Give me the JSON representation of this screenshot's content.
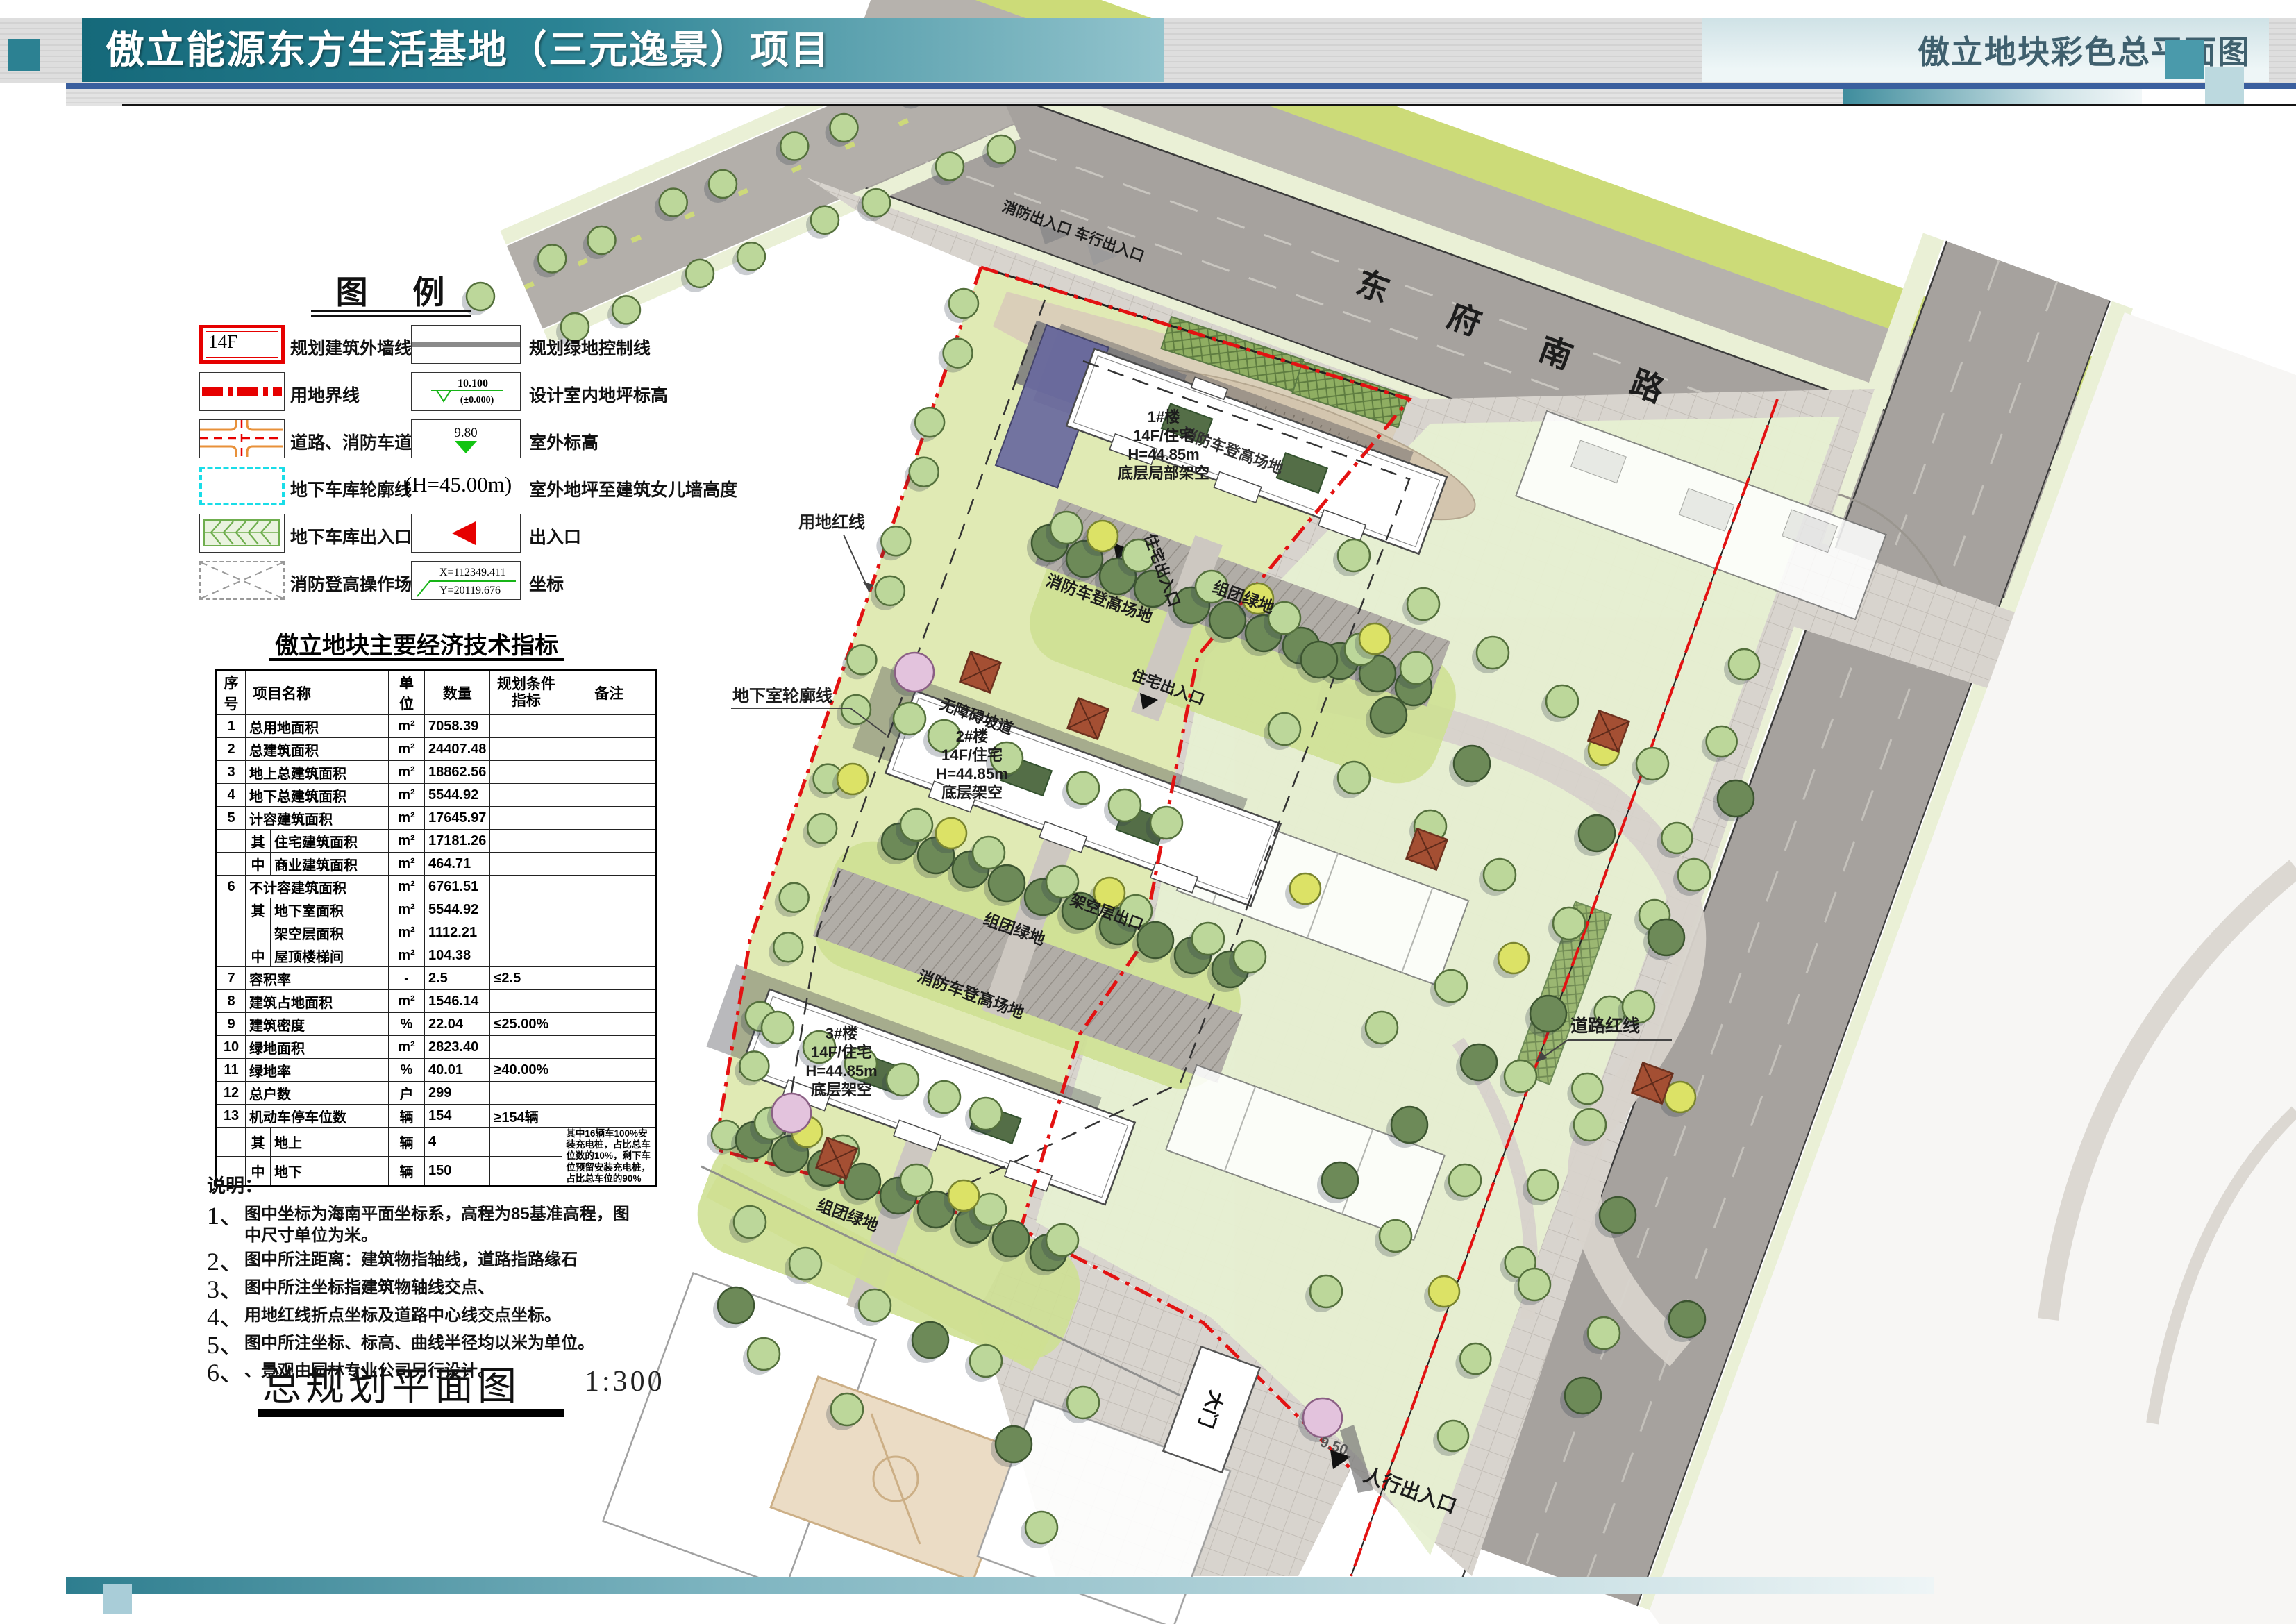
{
  "header": {
    "title": "傲立能源东方生活基地（三元逸景）项目",
    "subtitle": "傲立地块彩色总平面图"
  },
  "colors": {
    "header_teal": "#15697a",
    "header_blue_line": "#3a5f9e",
    "boundary_red": "#e31212",
    "garage_cyan": "#21dbe4",
    "road_gray": "#a6a29e",
    "site_green": "#e0eab4",
    "tree_green": "#bcd79a"
  },
  "legend": {
    "title": "图  例",
    "left": [
      {
        "symbol": "building-outline-symbol",
        "symbol_text": "14F",
        "label": "规划建筑外墙线及层数"
      },
      {
        "symbol": "land-boundary-symbol",
        "label": "用地界线"
      },
      {
        "symbol": "road-symbol",
        "label": "道路、消防车道"
      },
      {
        "symbol": "garage-outline-symbol",
        "label": "地下车库轮廓线"
      },
      {
        "symbol": "garage-entrance-symbol",
        "label": "地下车库出入口"
      },
      {
        "symbol": "fire-pad-symbol",
        "label": "消防登高操作场地"
      }
    ],
    "right": [
      {
        "symbol": "green-control-line-symbol",
        "label": "规划绿地控制线"
      },
      {
        "symbol": "indoor-level-symbol",
        "label": "设计室内地坪标高",
        "values": [
          "10.100",
          "(±0.000)"
        ]
      },
      {
        "symbol": "outdoor-level-symbol",
        "label": "室外标高",
        "value": "9.80"
      },
      {
        "symbol": "parapet-height-symbol",
        "label": "室外地坪至建筑女儿墙高度",
        "value": "(H=45.00m)"
      },
      {
        "symbol": "entrance-symbol",
        "label": "出入口"
      },
      {
        "symbol": "coordinate-symbol",
        "label": "坐标",
        "values": [
          "X=112349.411",
          "Y=20119.676"
        ]
      }
    ]
  },
  "indicators": {
    "title": "傲立地块主要经济技术指标",
    "headers": [
      "序号",
      "项目名称",
      "单位",
      "数量",
      "规划条件指标",
      "备注"
    ],
    "rows": [
      {
        "no": "1",
        "name": "总用地面积",
        "unit": "m²",
        "qty": "7058.39",
        "plan": "",
        "remark": ""
      },
      {
        "no": "2",
        "name": "总建筑面积",
        "unit": "m²",
        "qty": "24407.48",
        "plan": "",
        "remark": ""
      },
      {
        "no": "3",
        "name": "地上总建筑面积",
        "unit": "m²",
        "qty": "18862.56",
        "plan": "",
        "remark": ""
      },
      {
        "no": "4",
        "name": "地下总建筑面积",
        "unit": "m²",
        "qty": "5544.92",
        "plan": "",
        "remark": ""
      },
      {
        "no": "5",
        "name": "计容建筑面积",
        "unit": "m²",
        "qty": "17645.97",
        "plan": "",
        "remark": ""
      },
      {
        "no": "",
        "prefix": "其",
        "name": "住宅建筑面积",
        "unit": "m²",
        "qty": "17181.26",
        "plan": "",
        "remark": ""
      },
      {
        "no": "",
        "prefix": "中",
        "name": "商业建筑面积",
        "unit": "m²",
        "qty": "464.71",
        "plan": "",
        "remark": ""
      },
      {
        "no": "6",
        "name": "不计容建筑面积",
        "unit": "m²",
        "qty": "6761.51",
        "plan": "",
        "remark": ""
      },
      {
        "no": "",
        "prefix": "其",
        "name": "地下室面积",
        "unit": "m²",
        "qty": "5544.92",
        "plan": "",
        "remark": ""
      },
      {
        "no": "",
        "prefix": "",
        "name": "架空层面积",
        "unit": "m²",
        "qty": "1112.21",
        "plan": "",
        "remark": ""
      },
      {
        "no": "",
        "prefix": "中",
        "name": "屋顶楼梯间",
        "unit": "m²",
        "qty": "104.38",
        "plan": "",
        "remark": ""
      },
      {
        "no": "7",
        "name": "容积率",
        "unit": "-",
        "qty": "2.5",
        "plan": "≤2.5",
        "remark": ""
      },
      {
        "no": "8",
        "name": "建筑占地面积",
        "unit": "m²",
        "qty": "1546.14",
        "plan": "",
        "remark": ""
      },
      {
        "no": "9",
        "name": "建筑密度",
        "unit": "%",
        "qty": "22.04",
        "plan": "≤25.00%",
        "remark": ""
      },
      {
        "no": "10",
        "name": "绿地面积",
        "unit": "m²",
        "qty": "2823.40",
        "plan": "",
        "remark": ""
      },
      {
        "no": "11",
        "name": "绿地率",
        "unit": "%",
        "qty": "40.01",
        "plan": "≥40.00%",
        "remark": ""
      },
      {
        "no": "12",
        "name": "总户数",
        "unit": "户",
        "qty": "299",
        "plan": "",
        "remark": ""
      },
      {
        "no": "13",
        "name": "机动车停车位数",
        "unit": "辆",
        "qty": "154",
        "plan": "≥154辆",
        "remark": ""
      },
      {
        "no": "",
        "prefix": "其",
        "name": "地上",
        "unit": "辆",
        "qty": "4",
        "plan": "",
        "remark": "其中16辆车100%安装充电桩，占比总车位数的10%，剩下车位预留安装充电桩，占比总车位的90%",
        "remark_rowspan": 2
      },
      {
        "no": "",
        "prefix": "中",
        "name": "地下",
        "unit": "辆",
        "qty": "150",
        "plan": "",
        "remark": null
      }
    ]
  },
  "notes": {
    "title": "说明：",
    "items": [
      {
        "num": "1、",
        "text": "图中坐标为海南平面坐标系，高程为85基准高程，图中尺寸单位为米。"
      },
      {
        "num": "2、",
        "text": "图中所注距离：建筑物指轴线，道路指路缘石"
      },
      {
        "num": "3、",
        "text": "图中所注坐标指建筑物轴线交点、"
      },
      {
        "num": "4、",
        "text": "用地红线折点坐标及道路中心线交点坐标。"
      },
      {
        "num": "5、",
        "text": "图中所注坐标、标高、曲线半径均以米为单位。"
      },
      {
        "num": "6、",
        "text": "、景观由园林专业公司另行设计。"
      }
    ]
  },
  "plan_title": {
    "text": "总规划平面图",
    "scale": "1:300"
  },
  "map": {
    "road_name": "东  府  南  路",
    "labels": {
      "entrance_top": "消防出入口 车行出入口",
      "residence_entrance": "住宅出入口",
      "fire_area": "消防车登高场地",
      "group_green": "组团绿地",
      "ramp": "无障碍坡道",
      "stilt_exit": "架空层出口",
      "land_red_line": "用地红线",
      "basement_outline": "地下室轮廓线",
      "road_red_line": "道路红线",
      "gate": "大门",
      "pedestrian_entrance": "人行出入口",
      "pedestrian_elevation": "9.50"
    },
    "buildings": [
      {
        "id": "1#楼",
        "lines": [
          "1#楼",
          "14F/住宅",
          "H=44.85m",
          "底层局部架空"
        ]
      },
      {
        "id": "2#楼",
        "lines": [
          "2#楼",
          "14F/住宅",
          "H=44.85m",
          "底层架空"
        ]
      },
      {
        "id": "3#楼",
        "lines": [
          "3#楼",
          "14F/住宅",
          "H=44.85m",
          "底层架空"
        ]
      }
    ]
  }
}
